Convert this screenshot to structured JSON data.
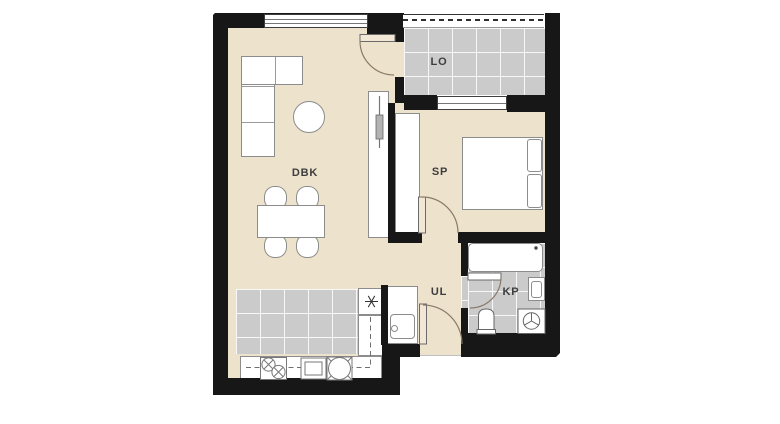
{
  "plan": {
    "kind": "apartment-floor-plan",
    "rooms": [
      {
        "label": "DBK",
        "name": "living-dining-kitchen"
      },
      {
        "label": "SP",
        "name": "bedroom"
      },
      {
        "label": "UL",
        "name": "entrance-hall"
      },
      {
        "label": "KP",
        "name": "bathroom"
      },
      {
        "label": "LO",
        "name": "loggia"
      }
    ],
    "fixtures": {
      "living_dining_kitchen": [
        "corner-sofa",
        "round-side-table",
        "dining-table",
        "chair",
        "chair",
        "chair",
        "chair",
        "tv-cabinet",
        "tv",
        "refrigerator-freezer",
        "kitchen-counter",
        "cooktop-two-burner",
        "oven",
        "round-sink",
        "overhead-cabinets-dashed"
      ],
      "entrance_hall": [
        "sink-cabinet"
      ],
      "bedroom": [
        "double-bed",
        "pillow",
        "pillow",
        "wardrobe"
      ],
      "bathroom": [
        "bathtub",
        "washbasin",
        "toilet",
        "washing-machine"
      ],
      "loggia": [
        "railing"
      ]
    },
    "doors": [
      "loggia-door",
      "bedroom-door",
      "bathroom-door",
      "entrance-door"
    ],
    "windows": [
      "living-room-window",
      "bedroom-window"
    ]
  },
  "colors": {
    "floor_beige": "#ede2cc",
    "tile_gray": "#cbcbcb",
    "wall_black": "#171717",
    "furn_border": "#8c8c8c",
    "door_arc": "#8a7b69",
    "label_color": "#3d3d3d"
  }
}
